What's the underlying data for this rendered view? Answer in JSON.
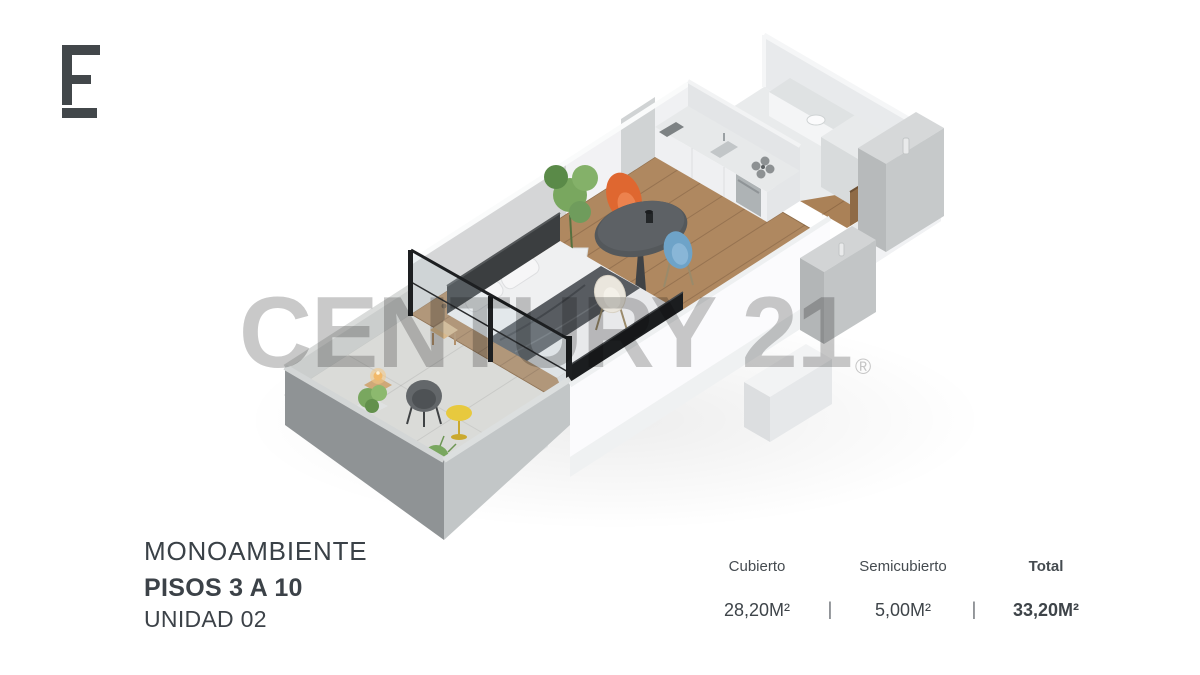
{
  "brand": {
    "logo_mark": "E-monogram",
    "watermark_text": "CENTURY 21",
    "registered_symbol": "®",
    "watermark_color": "#c9c9c9"
  },
  "unit_info": {
    "type_label": "MONOAMBIENTE",
    "floors_label": "PISOS 3 A 10",
    "unit_label": "UNIDAD 02"
  },
  "area_table": {
    "separator": "|",
    "columns": [
      {
        "header": "Cubierto",
        "value": "28,20M²"
      },
      {
        "header": "Semicubierto",
        "value": "5,00M²"
      },
      {
        "header": "Total",
        "value": "33,20M²"
      }
    ]
  },
  "floorplan": {
    "description": "Isometric 3D render of studio apartment (monoambiente) with balcony, bedroom, dining area, kitchen, bathroom and entry",
    "colors": {
      "wood_floor": "#aa8157",
      "wall_white": "#f2f2f4",
      "wall_gray": "#d5d6d7",
      "wall_face_front": "#fbfbfd",
      "concrete_dark": "#8f9395",
      "concrete_light": "#c2c6c7",
      "concrete_inner": "#cbcecd",
      "balcony_floor": "#dadbd8",
      "glass_frame": "#1d1f21",
      "bed_duvet": "#e8e9eb",
      "bed_throw": "#585c61",
      "headboard": "#3b3e40",
      "chair_orange": "#df6730",
      "chair_blue": "#6ea3c8",
      "chair_cream": "#eae6dd",
      "table_dark": "#54585b",
      "side_table_yellow": "#e7c93e",
      "plant_green": "#79a75f",
      "counter_top": "#e7e9ea",
      "door_wood": "#8f6b46",
      "tv_console": "#1b1d1f"
    }
  }
}
